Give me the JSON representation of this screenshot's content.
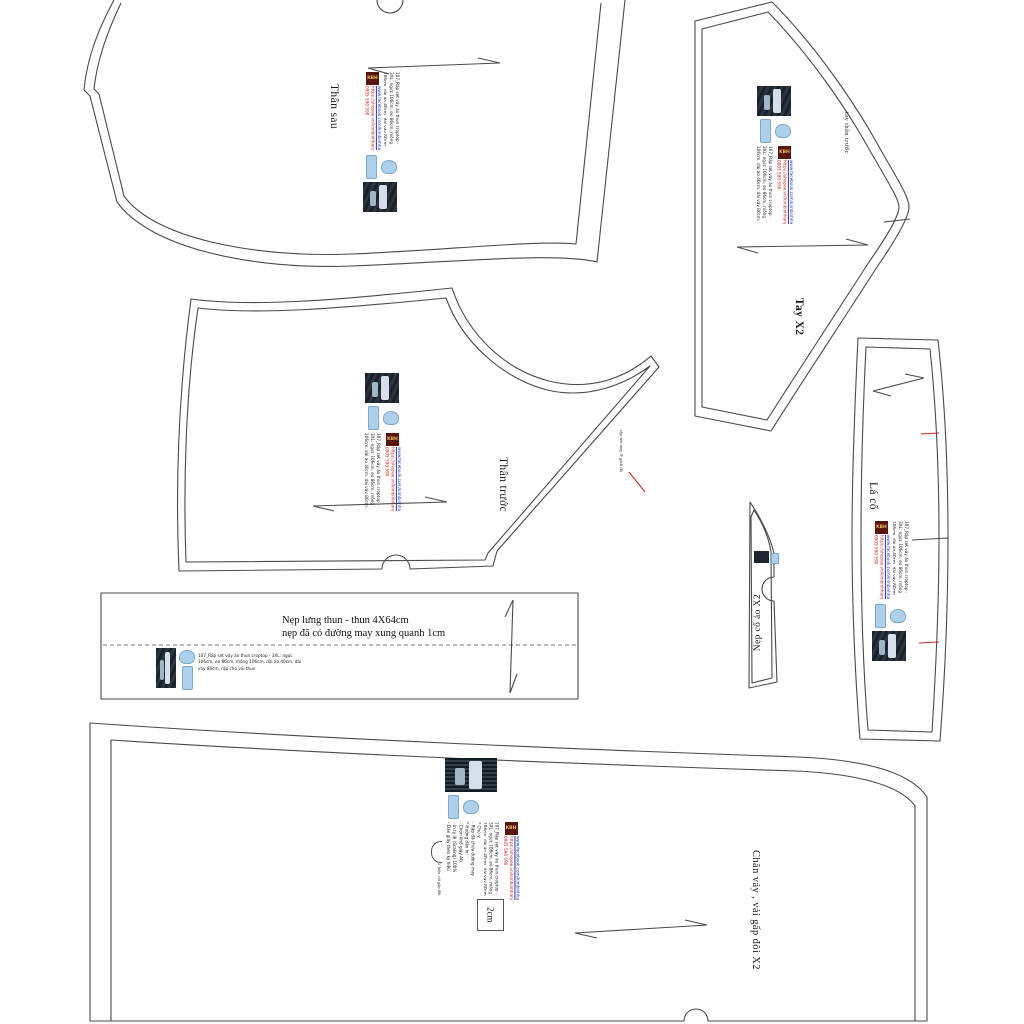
{
  "brand": {
    "logo_text": "KBH",
    "facebook_url": "www.facebook.com/kimbinhhang",
    "shopee_url": "https://shopee.vn/kimbinhhang",
    "phone": "0905 590 590",
    "pattern_description": "107_Rập set váy áo thun croptop - 3XL: ngực 106cm, eo 86cm, mông 106cm, dài áo 40cm, dài váy 80cm, rập cho vải thun"
  },
  "pieces": {
    "back_bodice": {
      "label": "Thân sau"
    },
    "sleeve": {
      "label": "Tay X2",
      "edge_note": "tay thân trước"
    },
    "front_bodice": {
      "label": "Thân trước",
      "edge_note": "rập xéo may lề gạch đỏ"
    },
    "waistband": {
      "line1": "Nẹp lưng thun - thun 4X64cm",
      "line2": "nẹp đã có đường may xung quanh 1cm"
    },
    "neck_facing": {
      "label": "Nẹp cổ áo X2"
    },
    "collar": {
      "label": "Lá cổ"
    },
    "skirt": {
      "label": "Chân váy , vải gấp đôi X2",
      "fold_note": "Kí hiệu vải gấp đôi",
      "scale_box": "2cm",
      "notes": "* Chú ý:\n- Rập đã chừa đường may\n* Hướng dẫn in:\n- Chọn khổ giấy A0\n- In tỷ lệ (Scaling) 100%\n- Dán giấy theo ký hiệu"
    }
  },
  "colors": {
    "outline": "#4a4a4a",
    "red_mark": "#cc2a2a",
    "link_blue": "#2233bb",
    "link_red": "#cc2222",
    "logo_bg": "#5a150f",
    "logo_gold": "#e7bd5f",
    "icon_blue": "#aed0ea"
  }
}
